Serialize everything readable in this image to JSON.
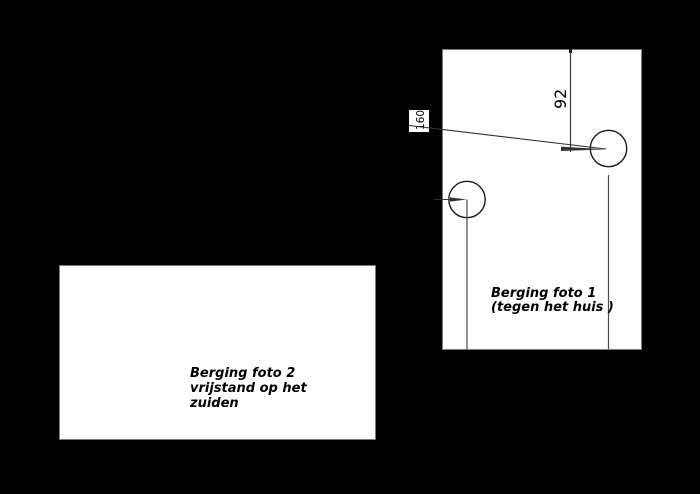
{
  "drawing": {
    "photo1": {
      "label": "Berging foto 1\n(tegen het huis )"
    },
    "photo2": {
      "label": "Berging foto 2\nvrijstand op het\nzuiden"
    },
    "dimensions": {
      "height_92": "92",
      "height_160": "160"
    },
    "colors": {
      "background": "#000000",
      "panel": "#ffffff",
      "panel_border": "#7a7a7a",
      "line": "#333333",
      "text": "#000000"
    }
  }
}
